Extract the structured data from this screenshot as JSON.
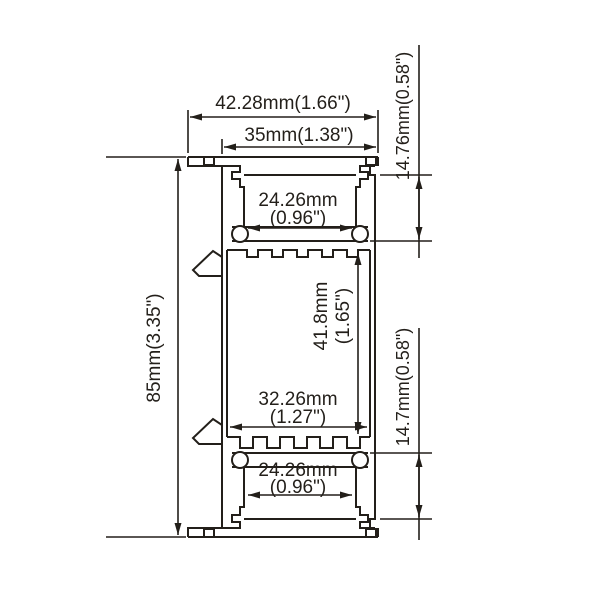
{
  "drawing": {
    "background": "#ffffff",
    "line_color": "#231f1a",
    "type": "technical-drawing-cross-section",
    "labels": {
      "overall_width": "42.28mm(1.66\")",
      "body_width": "35mm(1.38\")",
      "overall_height": "85mm(3.35\")",
      "top_recess_depth": "14.76mm(0.58\")",
      "bottom_recess_depth": "14.7mm(0.58\")",
      "top_channel_width_mm": "24.26mm",
      "top_channel_width_in": "(0.96\")",
      "cavity_height_mm": "41.8mm",
      "cavity_height_in": "(1.65\")",
      "cavity_width_mm": "32.26mm",
      "cavity_width_in": "(1.27\")",
      "bottom_channel_width_mm": "24.26mm",
      "bottom_channel_width_in": "(0.96\")"
    }
  }
}
